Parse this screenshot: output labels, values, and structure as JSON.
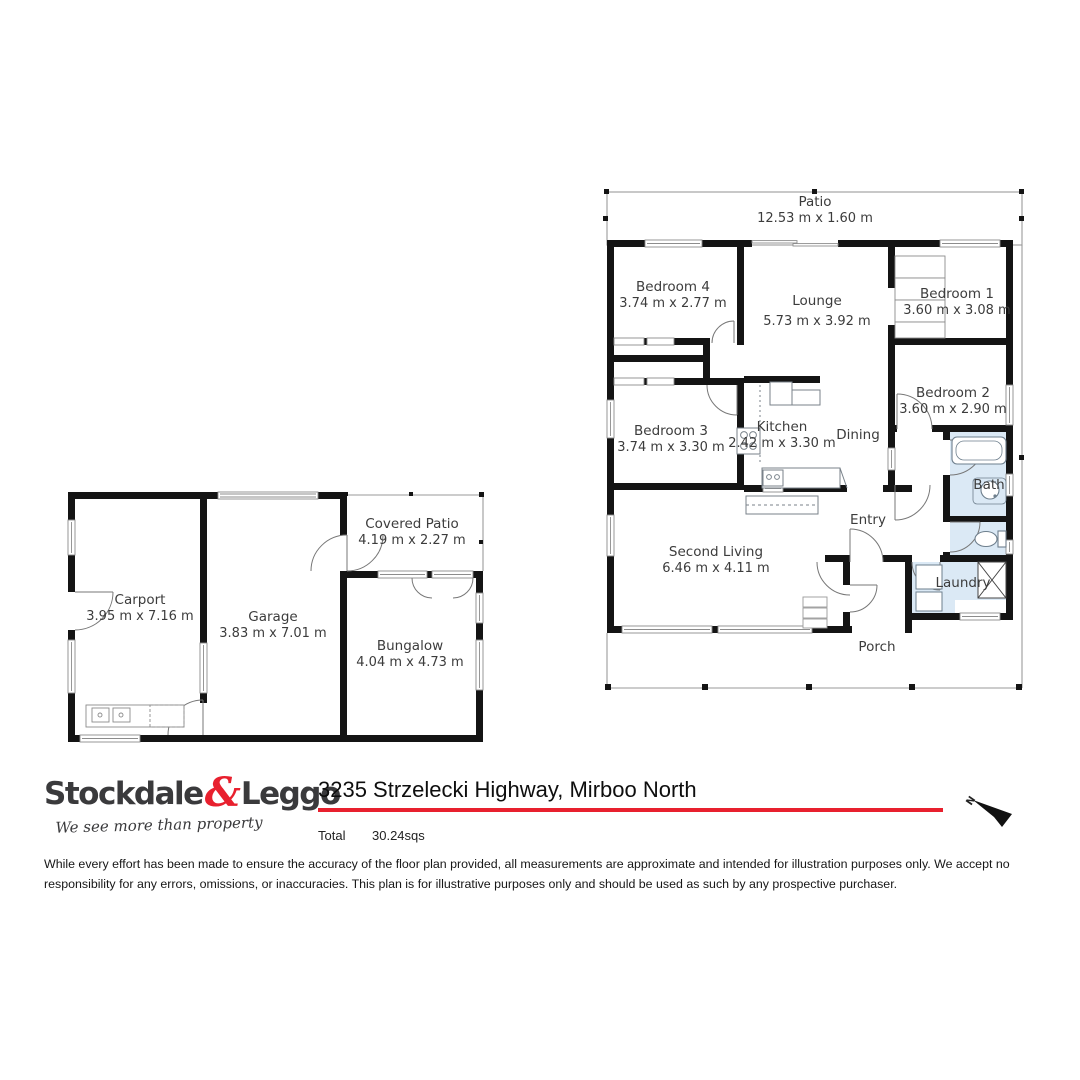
{
  "colors": {
    "wall": "#141414",
    "wet_area": "#dbe9f5",
    "thin_line": "#9a9a9a",
    "label_text": "#3c3c3c",
    "brand_red": "#e8202e",
    "brand_charcoal": "#3a3a3c"
  },
  "main_plan": {
    "rooms": [
      {
        "id": "patio",
        "name": "Patio",
        "dims": "12.53 m x 1.60 m"
      },
      {
        "id": "bedroom4",
        "name": "Bedroom 4",
        "dims": "3.74 m x 2.77 m"
      },
      {
        "id": "lounge",
        "name": "Lounge",
        "dims": "5.73 m x 3.92 m"
      },
      {
        "id": "bedroom1",
        "name": "Bedroom 1",
        "dims": "3.60 m x 3.08 m"
      },
      {
        "id": "bedroom2",
        "name": "Bedroom 2",
        "dims": "3.60 m x 2.90 m"
      },
      {
        "id": "bedroom3",
        "name": "Bedroom 3",
        "dims": "3.74 m x 3.30 m"
      },
      {
        "id": "kitchen",
        "name": "Kitchen",
        "dims": "2.42 m x 3.30 m"
      },
      {
        "id": "dining",
        "name": "Dining",
        "dims": ""
      },
      {
        "id": "bath",
        "name": "Bath",
        "dims": ""
      },
      {
        "id": "second_living",
        "name": "Second Living",
        "dims": "6.46 m x 4.11 m"
      },
      {
        "id": "entry",
        "name": "Entry",
        "dims": ""
      },
      {
        "id": "laundry",
        "name": "Laundry",
        "dims": ""
      },
      {
        "id": "porch",
        "name": "Porch",
        "dims": ""
      }
    ]
  },
  "outbuilding_plan": {
    "rooms": [
      {
        "id": "carport",
        "name": "Carport",
        "dims": "3.95 m x 7.16 m"
      },
      {
        "id": "garage",
        "name": "Garage",
        "dims": "3.83 m x 7.01 m"
      },
      {
        "id": "covered_patio",
        "name": "Covered Patio",
        "dims": "4.19 m x 2.27 m"
      },
      {
        "id": "bungalow",
        "name": "Bungalow",
        "dims": "4.04 m x 4.73 m"
      }
    ]
  },
  "footer": {
    "logo": {
      "brand_left": "Stockdale",
      "ampersand": "&",
      "brand_right": "Leggo",
      "tagline": "We see more than property"
    },
    "address": "3235 Strzelecki Highway, Mirboo North",
    "total_label": "Total",
    "total_value": "30.24sqs",
    "north_label": "N"
  },
  "disclaimer": "While every effort has been made to ensure the accuracy of the floor plan provided, all measurements are approximate and intended for illustration purposes only. We accept no responsibility for any errors, omissions, or inaccuracies. This plan is for illustrative purposes only and should be used as such by any prospective purchaser."
}
